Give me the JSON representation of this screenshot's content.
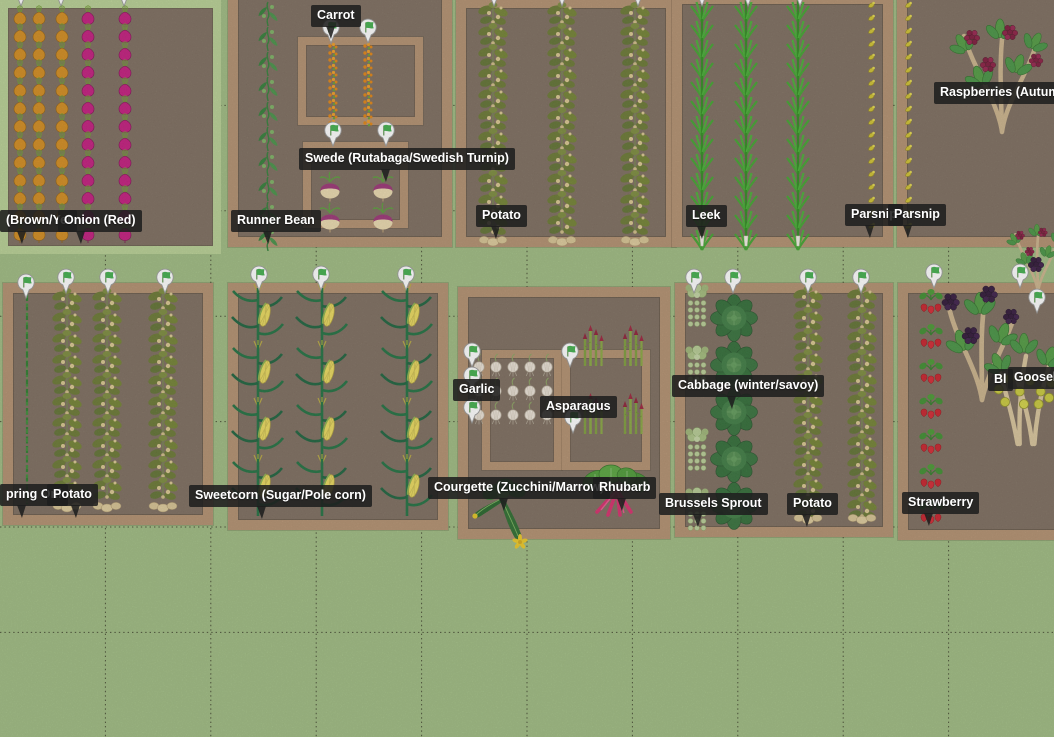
{
  "app": {
    "description": "Vegetable garden planner - plan view"
  },
  "canvas": {
    "width": 1054,
    "height": 737,
    "bg_color": "#9dba7f",
    "grid": {
      "size": 105.4,
      "cols": 9,
      "rows": 6,
      "line_color": "#2e2e1c"
    }
  },
  "colors": {
    "bed_frame": "#b18e6d",
    "soil": "#7b6b5c",
    "onion_bed_frame": "#b7cf92",
    "label_bg": "#1e1e1e",
    "label_text": "#ffffff",
    "marker_flag": "#3fae49",
    "marker_body": "#ffffff"
  },
  "beds": [
    {
      "name": "onion-bed",
      "x": 0,
      "y": 0,
      "w": 221,
      "h": 254,
      "frame": "green"
    },
    {
      "name": "runnerbean-carrot-swede-bed",
      "x": 228,
      "y": -12,
      "w": 224,
      "h": 259,
      "frame": "tan"
    },
    {
      "name": "potato-bed-top",
      "x": 456,
      "y": -2,
      "w": 220,
      "h": 249,
      "frame": "tan"
    },
    {
      "name": "leek-parsnip-bed",
      "x": 672,
      "y": -6,
      "w": 221,
      "h": 253,
      "frame": "tan"
    },
    {
      "name": "parsnip-raspberry-bed",
      "x": 897,
      "y": -12,
      "w": 170,
      "h": 259,
      "frame": "tan"
    },
    {
      "name": "springonion-potato-bed",
      "x": 3,
      "y": 283,
      "w": 210,
      "h": 242,
      "frame": "tan"
    },
    {
      "name": "sweetcorn-bed",
      "x": 228,
      "y": 283,
      "w": 220,
      "h": 247,
      "frame": "tan"
    },
    {
      "name": "garlic-asparagus-bed",
      "x": 458,
      "y": 287,
      "w": 212,
      "h": 252,
      "frame": "tan"
    },
    {
      "name": "cabbage-brussels-potato-bed",
      "x": 675,
      "y": 283,
      "w": 218,
      "h": 254,
      "frame": "tan"
    },
    {
      "name": "strawberry-berries-bed",
      "x": 898,
      "y": 283,
      "w": 170,
      "h": 257,
      "frame": "tan"
    }
  ],
  "inner_frames": [
    {
      "name": "carrot-inner-bed",
      "x": 298,
      "y": 37,
      "w": 125,
      "h": 88
    },
    {
      "name": "swede-inner-bed",
      "x": 303,
      "y": 142,
      "w": 105,
      "h": 86
    },
    {
      "name": "garlic-inner-bed",
      "x": 482,
      "y": 350,
      "w": 80,
      "h": 120
    },
    {
      "name": "asparagus-inner-bed",
      "x": 562,
      "y": 350,
      "w": 88,
      "h": 120
    }
  ],
  "plant_rows": [
    {
      "plant": "onion_brown",
      "x": 20,
      "y": 12,
      "step": 18,
      "count": 13
    },
    {
      "plant": "onion_brown",
      "x": 39,
      "y": 12,
      "step": 18,
      "count": 13
    },
    {
      "plant": "onion_brown",
      "x": 62,
      "y": 12,
      "step": 18,
      "count": 13
    },
    {
      "plant": "onion_red",
      "x": 88,
      "y": 12,
      "step": 18,
      "count": 13
    },
    {
      "plant": "onion_red",
      "x": 125,
      "y": 12,
      "step": 18,
      "count": 13
    },
    {
      "plant": "runnerbean",
      "x": 268,
      "y": 2,
      "step": 25,
      "count": 10
    },
    {
      "plant": "carrot",
      "x": 333,
      "y": 46,
      "step": 7,
      "count": 12
    },
    {
      "plant": "carrot",
      "x": 368,
      "y": 46,
      "step": 7,
      "count": 12
    },
    {
      "plant": "potato",
      "x": 493,
      "y": 14,
      "step": 21,
      "count": 11
    },
    {
      "plant": "potato",
      "x": 562,
      "y": 14,
      "step": 21,
      "count": 11
    },
    {
      "plant": "potato",
      "x": 635,
      "y": 14,
      "step": 21,
      "count": 11
    },
    {
      "plant": "leek",
      "x": 702,
      "y": 8,
      "step": 19,
      "count": 13
    },
    {
      "plant": "leek",
      "x": 746,
      "y": 8,
      "step": 19,
      "count": 13
    },
    {
      "plant": "leek",
      "x": 798,
      "y": 8,
      "step": 19,
      "count": 13
    },
    {
      "plant": "parsnip",
      "x": 871,
      "y": 6,
      "step": 13,
      "count": 18
    },
    {
      "plant": "parsnip",
      "x": 908,
      "y": 6,
      "step": 13,
      "count": 18
    },
    {
      "plant": "potato",
      "x": 67,
      "y": 300,
      "step": 21,
      "count": 10
    },
    {
      "plant": "potato",
      "x": 107,
      "y": 300,
      "step": 21,
      "count": 10
    },
    {
      "plant": "potato",
      "x": 163,
      "y": 300,
      "step": 21,
      "count": 10
    },
    {
      "plant": "corn",
      "x": 258,
      "y": 288,
      "step": 57,
      "count": 4
    },
    {
      "plant": "corn",
      "x": 322,
      "y": 288,
      "step": 57,
      "count": 4
    },
    {
      "plant": "corn",
      "x": 407,
      "y": 288,
      "step": 57,
      "count": 4
    },
    {
      "plant": "garlic",
      "x": 479,
      "y": 365,
      "step": 17,
      "count": 5,
      "dir": "h"
    },
    {
      "plant": "garlic",
      "x": 479,
      "y": 389,
      "step": 17,
      "count": 5,
      "dir": "h"
    },
    {
      "plant": "garlic",
      "x": 479,
      "y": 413,
      "step": 17,
      "count": 5,
      "dir": "h"
    },
    {
      "plant": "potato",
      "x": 808,
      "y": 298,
      "step": 21,
      "count": 11
    },
    {
      "plant": "potato",
      "x": 862,
      "y": 298,
      "step": 21,
      "count": 11
    },
    {
      "plant": "cabbage",
      "x": 734,
      "y": 318,
      "step": 47,
      "count": 5
    },
    {
      "plant": "strawberry",
      "x": 931,
      "y": 302,
      "step": 35,
      "count": 7
    }
  ],
  "plants": [
    {
      "plant": "sponion",
      "x": 27,
      "y": 294
    },
    {
      "plant": "swede",
      "x": 330,
      "y": 187
    },
    {
      "plant": "swede",
      "x": 383,
      "y": 187
    },
    {
      "plant": "swede",
      "x": 330,
      "y": 218
    },
    {
      "plant": "swede",
      "x": 383,
      "y": 218
    },
    {
      "plant": "tubers",
      "x": 493,
      "y": 240
    },
    {
      "plant": "tubers",
      "x": 562,
      "y": 240
    },
    {
      "plant": "tubers",
      "x": 635,
      "y": 240
    },
    {
      "plant": "leekend",
      "x": 702,
      "y": 236
    },
    {
      "plant": "leekend",
      "x": 746,
      "y": 236
    },
    {
      "plant": "leekend",
      "x": 798,
      "y": 236
    },
    {
      "plant": "tubers",
      "x": 67,
      "y": 506
    },
    {
      "plant": "tubers",
      "x": 107,
      "y": 506
    },
    {
      "plant": "tubers",
      "x": 163,
      "y": 506
    },
    {
      "plant": "asparagus",
      "x": 593,
      "y": 330
    },
    {
      "plant": "asparagus",
      "x": 633,
      "y": 330
    },
    {
      "plant": "asparagus",
      "x": 593,
      "y": 398
    },
    {
      "plant": "asparagus",
      "x": 633,
      "y": 398
    },
    {
      "plant": "brussels",
      "x": 697,
      "y": 288
    },
    {
      "plant": "brussels",
      "x": 697,
      "y": 350
    },
    {
      "plant": "brussels",
      "x": 697,
      "y": 432
    },
    {
      "plant": "brussels",
      "x": 697,
      "y": 492
    },
    {
      "plant": "tubers",
      "x": 808,
      "y": 518
    },
    {
      "plant": "tubers",
      "x": 862,
      "y": 518
    },
    {
      "plant": "raspberry",
      "x": 1002,
      "y": 132
    },
    {
      "plant": "raspberry",
      "x": 1038,
      "y": 292,
      "scale": 0.6
    },
    {
      "plant": "blackberry",
      "x": 982,
      "y": 400,
      "scale": 1.12
    },
    {
      "plant": "gooseberry",
      "x": 1026,
      "y": 444,
      "scale": 1.05
    },
    {
      "plant": "berries_black",
      "x": 1036,
      "y": 264
    },
    {
      "plant": "courgette",
      "x": 505,
      "y": 502
    },
    {
      "plant": "rhubarb",
      "x": 617,
      "y": 488
    }
  ],
  "markers": [
    {
      "x": 21,
      "y": -10
    },
    {
      "x": 61,
      "y": -10
    },
    {
      "x": 124,
      "y": -10
    },
    {
      "x": 494,
      "y": -10
    },
    {
      "x": 562,
      "y": -10
    },
    {
      "x": 638,
      "y": -10
    },
    {
      "x": 702,
      "y": -10
    },
    {
      "x": 748,
      "y": -10
    },
    {
      "x": 800,
      "y": -10
    },
    {
      "x": 331,
      "y": 27
    },
    {
      "x": 368,
      "y": 27
    },
    {
      "x": 333,
      "y": 130
    },
    {
      "x": 386,
      "y": 130
    },
    {
      "x": 26,
      "y": 282
    },
    {
      "x": 66,
      "y": 277
    },
    {
      "x": 108,
      "y": 277
    },
    {
      "x": 165,
      "y": 277
    },
    {
      "x": 259,
      "y": 274
    },
    {
      "x": 321,
      "y": 274
    },
    {
      "x": 406,
      "y": 274
    },
    {
      "x": 472,
      "y": 351
    },
    {
      "x": 472,
      "y": 375
    },
    {
      "x": 472,
      "y": 407
    },
    {
      "x": 570,
      "y": 351
    },
    {
      "x": 573,
      "y": 417
    },
    {
      "x": 694,
      "y": 277
    },
    {
      "x": 733,
      "y": 277
    },
    {
      "x": 808,
      "y": 277
    },
    {
      "x": 861,
      "y": 277
    },
    {
      "x": 934,
      "y": 272
    },
    {
      "x": 1020,
      "y": 272
    },
    {
      "x": 1037,
      "y": 297
    }
  ],
  "labels": [
    {
      "text": "(Brown/Yel",
      "x": 0,
      "y": 210,
      "tail_x": 21
    },
    {
      "text": "Onion (Red)",
      "x": 58,
      "y": 210,
      "tail_x": 80
    },
    {
      "text": "Carrot",
      "x": 311,
      "y": 5,
      "tail_x": 330
    },
    {
      "text": "Swede (Rutabaga/Swedish Turnip)",
      "x": 299,
      "y": 148,
      "tail_x": 385
    },
    {
      "text": "Runner Bean",
      "x": 231,
      "y": 210,
      "tail_x": 267
    },
    {
      "text": "Potato",
      "x": 476,
      "y": 205,
      "tail_x": 495
    },
    {
      "text": "Leek",
      "x": 686,
      "y": 205,
      "tail_x": 701
    },
    {
      "text": "Parsnip",
      "x": 845,
      "y": 204,
      "tail_x": 869
    },
    {
      "text": "Parsnip",
      "x": 888,
      "y": 204,
      "tail_x": 907
    },
    {
      "text": "Raspberries (Autumn Fru",
      "x": 934,
      "y": 82
    },
    {
      "text": "pring Oni",
      "x": 0,
      "y": 484,
      "tail_x": 21
    },
    {
      "text": "Potato",
      "x": 47,
      "y": 484,
      "tail_x": 75
    },
    {
      "text": "Sweetcorn (Sugar/Pole corn)",
      "x": 189,
      "y": 485,
      "tail_x": 261
    },
    {
      "text": "Garlic",
      "x": 453,
      "y": 379
    },
    {
      "text": "Asparagus",
      "x": 540,
      "y": 396
    },
    {
      "text": "Courgette (Zucchini/Marrow)",
      "x": 428,
      "y": 477,
      "tail_x": 503
    },
    {
      "text": "Rhubarb",
      "x": 593,
      "y": 477,
      "tail_x": 621
    },
    {
      "text": "Cabbage (winter/savoy)",
      "x": 672,
      "y": 375,
      "tail_x": 731
    },
    {
      "text": "Brussels Sprout",
      "x": 659,
      "y": 493,
      "tail_x": 697
    },
    {
      "text": "Potato",
      "x": 787,
      "y": 493,
      "tail_x": 806
    },
    {
      "text": "Strawberry",
      "x": 902,
      "y": 492,
      "tail_x": 928
    },
    {
      "text": "Bl",
      "x": 988,
      "y": 369
    },
    {
      "text": "Gooseber",
      "x": 1008,
      "y": 367
    }
  ]
}
